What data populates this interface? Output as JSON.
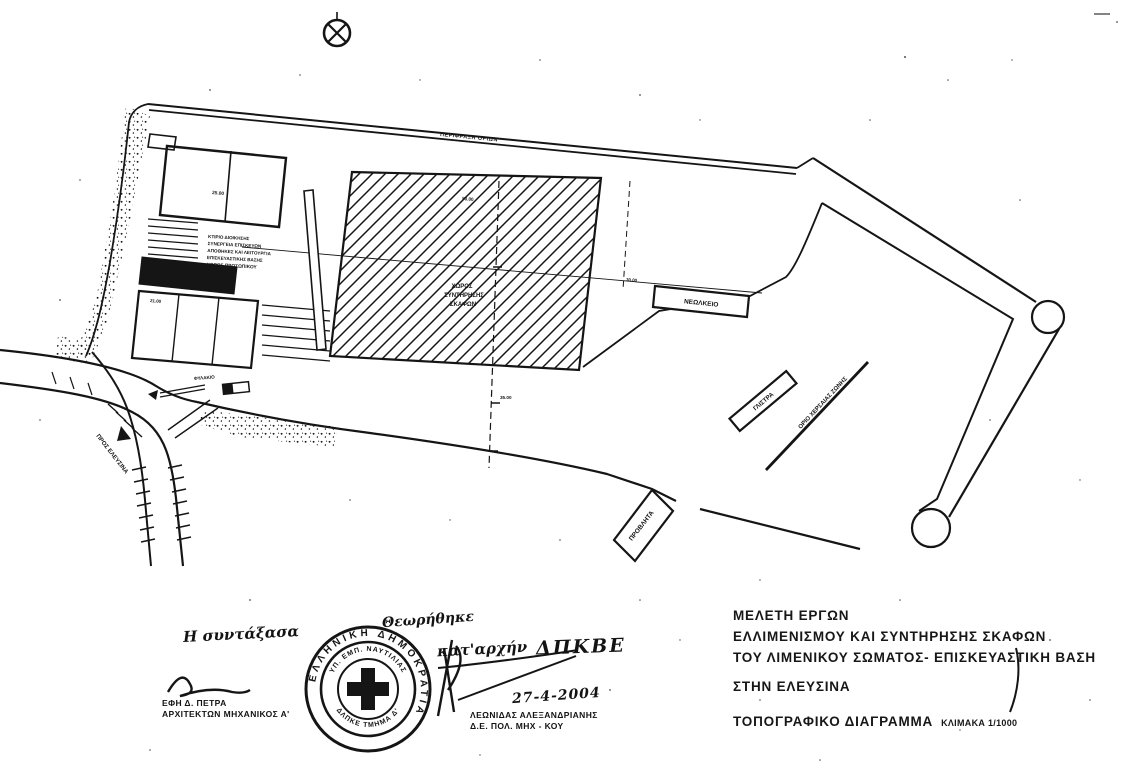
{
  "plan": {
    "fence_label": "ΠΕΡΙΦΡΑΞΗ ΟΡΙΩΝ",
    "maintenance_area": [
      "ΧΩΡΟΣ",
      "ΣΥΝΤΗΡΗΣΗΣ",
      "ΣΚΑΦΩΝ"
    ],
    "slipway_label": "ΝΕΩΛΚΕΙΟ",
    "pier_label": "ΠΡΟΒΛΗΤΑ",
    "slip_label": "ΓΛΙΣΤΡΑ",
    "zone_boundary_label": "ΟΡΙΟ ΧΕΡΣΑΙΑΣ ΖΩΝΗΣ",
    "road_label": "ΠΡΟΣ ΕΛΕΥΣΙΝΑ",
    "guardhouse_label": "ΦΥΛΑΚΙΟ",
    "building_note_lines": [
      "ΚΤΙΡΙΟ ΔΙΟΙΚΗΣΗΣ",
      "ΣΥΝΕΡΓΕΙΑ ΕΠΙΣΚΕΥΩΝ",
      "ΑΠΟΘΗΚΕΣ ΚΑΙ ΛΕΙΤΟΥΡΓΙΑ",
      "ΕΠΙΣΚΕΥΑΣΤΙΚΗΣ ΒΑΣΗΣ",
      "ΧΩΡΟΣ ΠΡΟΣΩΠΙΚΟΥ"
    ],
    "dimensions": {
      "building_a": "25.00",
      "building_b": "21.00",
      "yard": "50.00",
      "waterfront": "35.00",
      "quay": "30.00"
    }
  },
  "title_block": {
    "line1": "ΜΕΛΕΤΗ ΕΡΓΩΝ",
    "line2": "ΕΛΛΙΜΕΝΙΣΜΟΥ ΚΑΙ ΣΥΝΤΗΡΗΣΗΣ ΣΚΑΦΩΝ",
    "line3": "ΤΟΥ ΛΙΜΕΝΙΚΟΥ ΣΩΜΑΤΟΣ- ΕΠΙΣΚΕΥΑΣΤΙΚΗ ΒΑΣΗ",
    "line4": "ΣΤΗΝ ΕΛΕΥΣΙΝΑ",
    "line5": "ΤΟΠΟΓΡΑΦΙΚΟ ΔΙΑΓΡΑΜΜΑ",
    "scale": "ΚΛΙΜΑΚΑ 1/1000"
  },
  "approvals": {
    "left": {
      "handwritten": "Η συντάξασα",
      "name": "ΕΦΗ Δ. ΠΕΤΡΑ",
      "title": "ΑΡΧΙΤΕΚΤΩΝ ΜΗΧΑΝΙΚΟΣ Α'"
    },
    "stamp": {
      "outer_ring": "ΕΛΛΗΝΙΚΗ ΔΗΜΟΚΡΑΤΙΑ",
      "inner_top": "ΥΠ. ΕΜΠ. ΝΑΥΤΙΛΙΑΣ",
      "inner_bottom": "ΔΛΠΚΕ ΤΜΗΜΑ Δ'"
    },
    "right": {
      "handwritten1": "Θεωρήθηκε",
      "handwritten2": "κατ'αρχήν",
      "handwritten3": "ΔΠΚΒΕ",
      "date": "27-4-2004",
      "name": "ΛΕΩΝΙΔΑΣ ΑΛΕΞΑΝΔΡΙΑΝΗΣ",
      "title": "Δ.Ε. ΠΟΛ. ΜΗΧ - ΚΟΥ"
    }
  },
  "colors": {
    "ink": "#151515",
    "paper": "#ffffff"
  }
}
